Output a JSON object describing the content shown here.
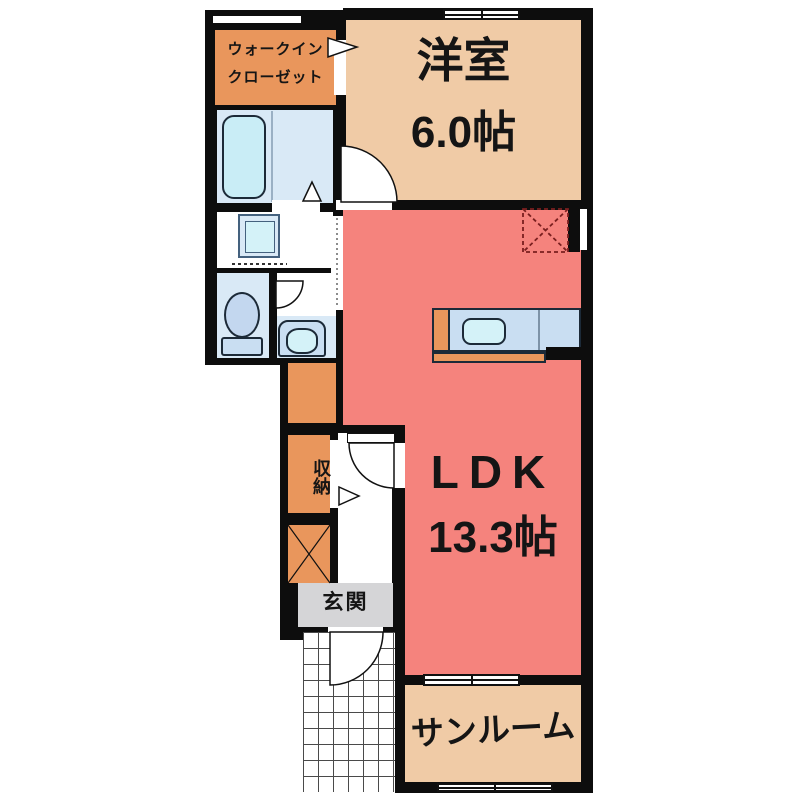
{
  "title": "1LDK apartment floor plan",
  "rooms": {
    "walk_in_closet": {
      "label_line1": "ウォークイン",
      "label_line2": "クローゼット"
    },
    "western_room": {
      "label": "洋室",
      "size": "6.0帖"
    },
    "ldk": {
      "label": "LDK",
      "size": "13.3帖"
    },
    "storage": {
      "label": "収納"
    },
    "entrance": {
      "label": "玄関"
    },
    "sunroom": {
      "label": "サンルーム"
    }
  },
  "fixtures": {
    "bathtub": "bathtub",
    "washing_machine_pan": "washing-machine-pan",
    "toilet": "toilet",
    "washbasin": "washbasin-vanity",
    "kitchen_counter": "kitchen-counter-with-sink",
    "refrigerator_space": "refrigerator-space-dashed",
    "entrance_porch": "tiled-porch-grid"
  },
  "colors": {
    "wall": "#0d0d0d",
    "room_tan": "#f0cba6",
    "room_salmon": "#f5837d",
    "room_orange": "#e9965c",
    "floor_lightblue": "#d9e9f6",
    "counter_blue": "#c9def2",
    "fixture_cyan": "#c9edf6",
    "fixture_blue": "#c3d7ef",
    "sink_cyan": "#d4f2f8",
    "entrance_gray": "#d5d5d7",
    "text": "#151515"
  }
}
